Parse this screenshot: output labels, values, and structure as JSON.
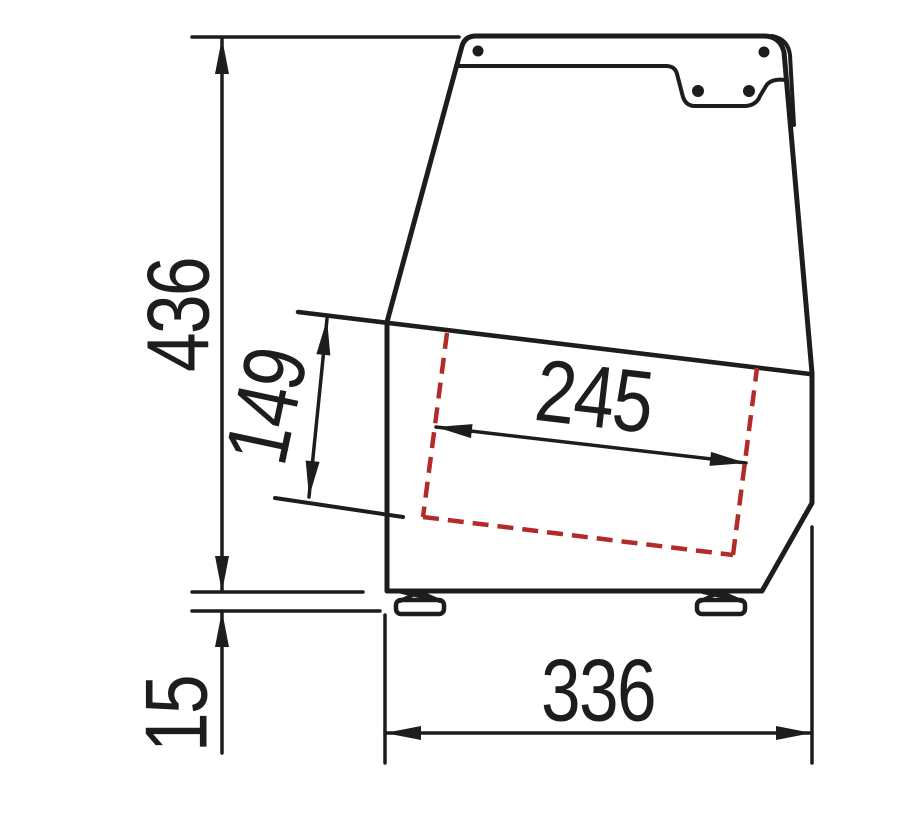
{
  "diagram": {
    "description": "Side profile technical drawing of a countertop display case with dimension lines",
    "dimensions": {
      "overall_height": "436",
      "well_depth": "149",
      "tray_width": "245",
      "base_depth": "336",
      "foot_height": "15"
    },
    "colors": {
      "line": "#1d1d1b",
      "tray_outline": "#b32b28",
      "background": "#ffffff"
    }
  }
}
